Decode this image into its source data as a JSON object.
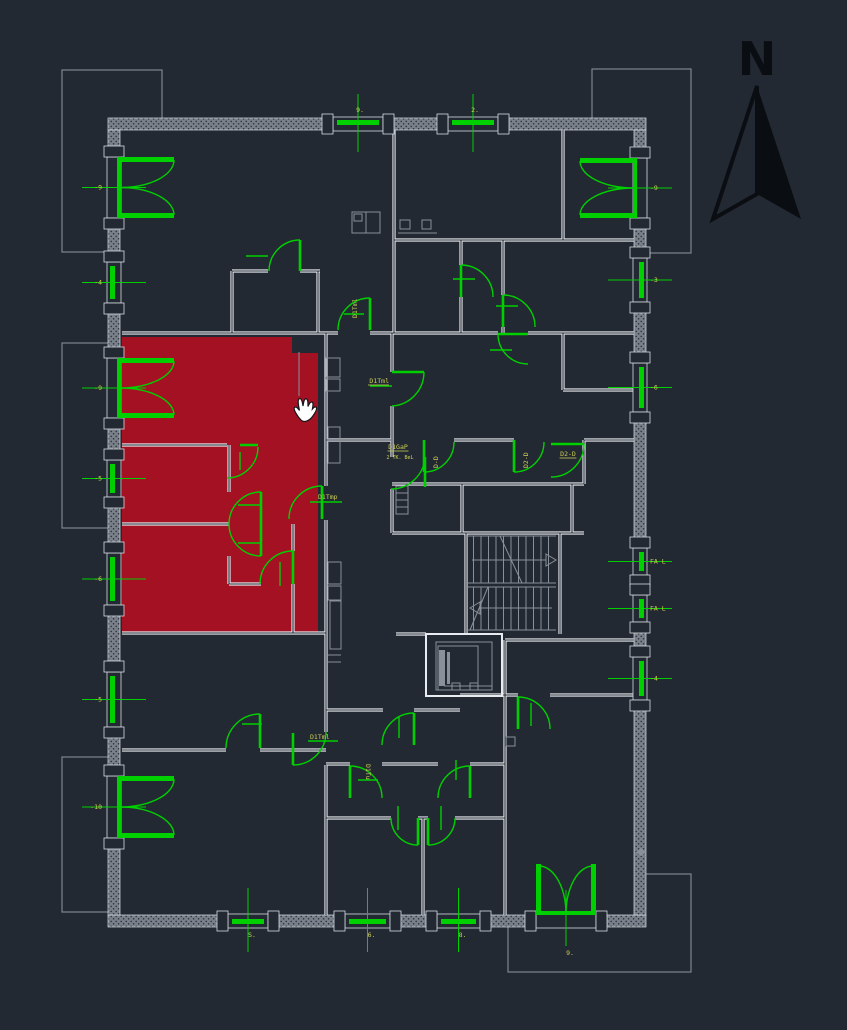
{
  "meta": {
    "width": 847,
    "height": 1030,
    "app": "cad-floorplan-view"
  },
  "colors": {
    "bg": "#232933",
    "wall_base": "#79808a",
    "wall_dot": "#2c323c",
    "wall_edge": "#d6dbe1",
    "interior_wall": "#e8ebef",
    "gray": "#8a9099",
    "green": "#00d000",
    "yellow": "#cdd155",
    "red": "#a31123",
    "black": "#0a0d12",
    "cursor_fill": "#ffffff",
    "cursor_edge": "#14161a"
  },
  "north": {
    "label": "N",
    "solid": "M757,86 L801,219 L757,194 Z",
    "outline": "M757,86 L713,219 L757,194 Z"
  },
  "plan": {
    "building": {
      "x": 108,
      "y": 118,
      "w": 538,
      "h": 809,
      "wall": 12
    },
    "balconies": [
      [
        62,
        70,
        100,
        182
      ],
      [
        62,
        343,
        48,
        185
      ],
      [
        62,
        757,
        48,
        155
      ],
      [
        592,
        69,
        99,
        184
      ],
      [
        508,
        874,
        183,
        98
      ]
    ],
    "wall_segments": [
      [
        108,
        118,
        225,
        12
      ],
      [
        383,
        118,
        65,
        12
      ],
      [
        498,
        118,
        148,
        12
      ],
      [
        108,
        915,
        120,
        12
      ],
      [
        268,
        915,
        77,
        12
      ],
      [
        390,
        915,
        47,
        12
      ],
      [
        480,
        915,
        56,
        12
      ],
      [
        596,
        915,
        50,
        12
      ],
      [
        108,
        130,
        12,
        27
      ],
      [
        108,
        218,
        12,
        44
      ],
      [
        108,
        303,
        12,
        55
      ],
      [
        108,
        418,
        12,
        42
      ],
      [
        108,
        497,
        12,
        56
      ],
      [
        108,
        605,
        12,
        67
      ],
      [
        108,
        727,
        12,
        49
      ],
      [
        108,
        838,
        12,
        77
      ],
      [
        634,
        130,
        12,
        28
      ],
      [
        634,
        218,
        12,
        40
      ],
      [
        634,
        302,
        12,
        61
      ],
      [
        634,
        412,
        12,
        136
      ],
      [
        634,
        575,
        12,
        20
      ],
      [
        634,
        622,
        12,
        35
      ],
      [
        634,
        700,
        12,
        215
      ]
    ],
    "openings": [
      {
        "side": "L",
        "a": 157,
        "b": 218,
        "kind": "dd",
        "label": "-9"
      },
      {
        "side": "L",
        "a": 262,
        "b": 303,
        "kind": "w",
        "label": "-4"
      },
      {
        "side": "L",
        "a": 358,
        "b": 418,
        "kind": "dd",
        "label": "-9"
      },
      {
        "side": "L",
        "a": 460,
        "b": 497,
        "kind": "w",
        "label": "-5"
      },
      {
        "side": "L",
        "a": 553,
        "b": 605,
        "kind": "w",
        "label": "-6"
      },
      {
        "side": "L",
        "a": 672,
        "b": 727,
        "kind": "w",
        "label": "-5"
      },
      {
        "side": "L",
        "a": 776,
        "b": 838,
        "kind": "dd",
        "label": "-10"
      },
      {
        "side": "R",
        "a": 158,
        "b": 218,
        "kind": "dd",
        "label": "-9"
      },
      {
        "side": "R",
        "a": 258,
        "b": 302,
        "kind": "w",
        "label": "-3"
      },
      {
        "side": "R",
        "a": 363,
        "b": 412,
        "kind": "w",
        "label": "-6"
      },
      {
        "side": "R",
        "a": 548,
        "b": 575,
        "kind": "w",
        "label": "FA L"
      },
      {
        "side": "R",
        "a": 595,
        "b": 622,
        "kind": "w",
        "label": "FA L"
      },
      {
        "side": "R",
        "a": 657,
        "b": 700,
        "kind": "w",
        "label": "-4"
      },
      {
        "side": "T",
        "a": 333,
        "b": 383,
        "kind": "w",
        "label": "9."
      },
      {
        "side": "T",
        "a": 448,
        "b": 498,
        "kind": "w",
        "label": "2."
      },
      {
        "side": "B",
        "a": 228,
        "b": 268,
        "kind": "w",
        "label": "S."
      },
      {
        "side": "B",
        "a": 345,
        "b": 390,
        "kind": "w",
        "label": "6."
      },
      {
        "side": "B",
        "a": 437,
        "b": 480,
        "kind": "w",
        "label": "8."
      },
      {
        "side": "B",
        "a": 536,
        "b": 596,
        "kind": "dd",
        "label": "9."
      }
    ],
    "red_unit": {
      "points": "122,337 292,337 292,353 318,353 318,633 122,633"
    },
    "interior_walls": [
      [
        232,
        271,
        268,
        271
      ],
      [
        300,
        271,
        320,
        271
      ],
      [
        122,
        333,
        338,
        333
      ],
      [
        370,
        333,
        498,
        333
      ],
      [
        528,
        333,
        634,
        333
      ],
      [
        394,
        240,
        634,
        240
      ],
      [
        326,
        440,
        391,
        440
      ],
      [
        454,
        440,
        514,
        440
      ],
      [
        584,
        440,
        634,
        440
      ],
      [
        392,
        484,
        584,
        484
      ],
      [
        392,
        533,
        584,
        533
      ],
      [
        122,
        445,
        227,
        445
      ],
      [
        122,
        524,
        229,
        524
      ],
      [
        229,
        584,
        261,
        584
      ],
      [
        122,
        633,
        326,
        633
      ],
      [
        122,
        750,
        226,
        750
      ],
      [
        260,
        750,
        326,
        750
      ],
      [
        326,
        710,
        383,
        710
      ],
      [
        414,
        710,
        460,
        710
      ],
      [
        460,
        695,
        518,
        695
      ],
      [
        550,
        695,
        634,
        695
      ],
      [
        326,
        764,
        350,
        764
      ],
      [
        382,
        764,
        438,
        764
      ],
      [
        470,
        764,
        505,
        764
      ],
      [
        326,
        818,
        391,
        818
      ],
      [
        455,
        818,
        505,
        818
      ],
      [
        418,
        818,
        428,
        818
      ],
      [
        563,
        390,
        634,
        390
      ],
      [
        232,
        271,
        232,
        333
      ],
      [
        318,
        271,
        318,
        333
      ],
      [
        394,
        130,
        394,
        333
      ],
      [
        461,
        240,
        461,
        265
      ],
      [
        461,
        297,
        461,
        333
      ],
      [
        503,
        240,
        503,
        295
      ],
      [
        503,
        327,
        503,
        333
      ],
      [
        563,
        130,
        563,
        240
      ],
      [
        326,
        333,
        326,
        486
      ],
      [
        326,
        520,
        326,
        732
      ],
      [
        326,
        765,
        326,
        915
      ],
      [
        229,
        445,
        229,
        492
      ],
      [
        229,
        556,
        229,
        584
      ],
      [
        293,
        524,
        293,
        551
      ],
      [
        293,
        584,
        293,
        633
      ],
      [
        392,
        333,
        392,
        372
      ],
      [
        392,
        406,
        392,
        457
      ],
      [
        392,
        489,
        392,
        533
      ],
      [
        462,
        484,
        462,
        533
      ],
      [
        572,
        484,
        572,
        533
      ],
      [
        584,
        440,
        584,
        484
      ],
      [
        505,
        640,
        505,
        915
      ],
      [
        505,
        640,
        634,
        640
      ],
      [
        423,
        818,
        423,
        915
      ],
      [
        563,
        333,
        563,
        390
      ],
      [
        466,
        533,
        466,
        634
      ],
      [
        560,
        533,
        560,
        634
      ],
      [
        396,
        634,
        426,
        634
      ]
    ],
    "doors": [
      {
        "leaf": [
          300,
          240,
          300,
          271
        ],
        "arc": "M300,240 A31,31 0 0 0 269,271",
        "tick": [
          246,
          256,
          268,
          256
        ]
      },
      {
        "leaf": [
          370,
          298,
          370,
          330
        ],
        "arc": "M370,298 A32,32 0 0 0 338,330",
        "tick": [
          344,
          314,
          364,
          314
        ],
        "label": {
          "t": "D1Tml",
          "x": 357,
          "y": 318,
          "rot": -90
        }
      },
      {
        "leaf": [
          392,
          372,
          424,
          372
        ],
        "arc": "M424,372 A34,34 0 0 1 392,406",
        "tick": [
          370,
          386,
          392,
          386
        ],
        "label": {
          "t": "D1Tml",
          "x": 389,
          "y": 383,
          "anchor": "end",
          "ul": true
        }
      },
      {
        "leaf": [
          461,
          265,
          461,
          297
        ],
        "arc": "M461,265 A32,32 0 0 1 493,297",
        "tick": [
          453,
          279,
          475,
          279
        ]
      },
      {
        "leaf": [
          503,
          295,
          503,
          327
        ],
        "arc": "M503,295 A32,32 0 0 1 535,327",
        "tick": [
          496,
          306,
          518,
          306
        ]
      },
      {
        "leaf": [
          498,
          334,
          528,
          334
        ],
        "arc": "M498,334 A30,30 0 0 0 528,364",
        "tick": [
          490,
          350,
          512,
          350
        ]
      },
      {
        "leaf": [
          551,
          444,
          584,
          444
        ],
        "arc": "M584,444 A33,33 0 0 1 551,477",
        "label": {
          "t": "D2-D",
          "x": 568,
          "y": 456,
          "anchor": "middle",
          "ul": true
        }
      },
      {
        "leaf": [
          424,
          440,
          424,
          472
        ],
        "arc": "M424,472 A30,30 0 0 0 454,442",
        "label": {
          "t": "D-D",
          "x": 438,
          "y": 468,
          "rot": -90
        }
      },
      {
        "leaf": [
          514,
          440,
          514,
          472
        ],
        "arc": "M514,472 A30,30 0 0 0 544,442",
        "label": {
          "t": "D2-D",
          "x": 528,
          "y": 468,
          "rot": -90
        }
      },
      {
        "leaf": [
          425,
          457,
          425,
          487
        ],
        "arc": "M425,457 A34,34 0 0 1 391,489",
        "label": {
          "t": "D1GaP",
          "x": 398,
          "y": 449,
          "anchor": "middle",
          "ul": true
        },
        "label2": {
          "t": "2 TK. BeL",
          "x": 400,
          "y": 459,
          "anchor": "middle"
        }
      },
      {
        "leaf": [
          322,
          486,
          322,
          519
        ],
        "arc": "M322,486 A33,33 0 0 0 289,519",
        "tick": [
          310,
          502,
          342,
          502
        ],
        "label": {
          "t": "D1Tmp",
          "x": 318,
          "y": 499
        }
      },
      {
        "leaf": [
          261,
          492,
          261,
          524
        ],
        "arc": "M261,492 A32,32 0 0 0 229,524",
        "tick": [
          238,
          505,
          260,
          505
        ]
      },
      {
        "leaf": [
          261,
          556,
          261,
          524
        ],
        "arc": "M261,556 A32,32 0 0 1 229,524",
        "tick": [
          238,
          543,
          260,
          543
        ]
      },
      {
        "leaf": [
          293,
          551,
          293,
          584
        ],
        "arc": "M293,551 A33,33 0 0 0 260,584",
        "tick": [
          280,
          562,
          280,
          586
        ]
      },
      {
        "leaf": [
          240,
          445,
          258,
          445
        ],
        "arc": "M258,447 A31,31 0 0 1 227,478",
        "tick": [
          240,
          452,
          240,
          470
        ]
      },
      {
        "leaf": [
          260,
          714,
          260,
          748
        ],
        "arc": "M260,714 A34,34 0 0 0 226,748",
        "tick": [
          242,
          724,
          262,
          724
        ]
      },
      {
        "leaf": [
          293,
          733,
          293,
          765
        ],
        "arc": "M293,765 A33,33 0 0 0 326,732",
        "tick": [
          308,
          741,
          338,
          741
        ],
        "label": {
          "t": "D1Tml",
          "x": 310,
          "y": 739
        }
      },
      {
        "leaf": [
          350,
          766,
          350,
          798
        ],
        "arc": "M350,766 A32,32 0 0 1 382,798",
        "tick": [
          358,
          780,
          378,
          780
        ],
        "label": {
          "t": "D1Tu",
          "x": 366,
          "y": 764,
          "rot": 90
        }
      },
      {
        "leaf": [
          470,
          766,
          470,
          798
        ],
        "arc": "M470,766 A32,32 0 0 0 438,798",
        "tick": [
          456,
          760,
          456,
          780
        ]
      },
      {
        "leaf": [
          418,
          818,
          418,
          845
        ],
        "arc": "M391,818 A27,27 0 0 0 418,845",
        "tick": [
          398,
          806,
          398,
          830
        ]
      },
      {
        "leaf": [
          428,
          818,
          428,
          845
        ],
        "arc": "M455,818 A27,27 0 0 1 428,845",
        "tick": [
          441,
          806,
          441,
          830
        ]
      },
      {
        "leaf": [
          414,
          713,
          414,
          745
        ],
        "arc": "M414,713 A32,32 0 0 0 382,745",
        "tick": [
          399,
          716,
          399,
          738
        ]
      },
      {
        "leaf": [
          518,
          697,
          518,
          729
        ],
        "arc": "M518,697 A32,32 0 0 1 550,729",
        "tick": [
          531,
          703,
          531,
          726
        ]
      }
    ],
    "stairs": {
      "x": 466,
      "y1": 536,
      "y2": 583,
      "y3": 587,
      "y4": 630,
      "w": 90,
      "treads": 12,
      "up_arrow": [
        472,
        560,
        546,
        560
      ],
      "up_head": "546,554 556,560 546,566",
      "dn_arrow": [
        480,
        608,
        552,
        608
      ],
      "dn_head": "480,602 470,608 480,614",
      "diag1": [
        500,
        536,
        522,
        583
      ],
      "diag2": [
        488,
        587,
        470,
        630
      ]
    },
    "elevator": {
      "outer": [
        426,
        634,
        76,
        62
      ],
      "inner": [
        436,
        642,
        56,
        48
      ],
      "car": [
        438,
        646,
        40,
        44
      ],
      "rails": [
        [
          439,
          650,
          6,
          36
        ],
        [
          447,
          652,
          3,
          32
        ]
      ],
      "lines": [
        [
          444,
          686,
          492,
          686
        ],
        [
          444,
          690,
          492,
          690
        ]
      ],
      "boxes": [
        [
          452,
          683,
          8,
          7
        ],
        [
          470,
          683,
          8,
          7
        ]
      ]
    },
    "fixtures_rects": [
      [
        352,
        212,
        28,
        21
      ],
      [
        354,
        214,
        8,
        7
      ],
      [
        400,
        220,
        10,
        9
      ],
      [
        422,
        220,
        9,
        9
      ],
      [
        326,
        358,
        14,
        19
      ],
      [
        326,
        379,
        14,
        12
      ],
      [
        328,
        427,
        12,
        36
      ],
      [
        328,
        562,
        13,
        22
      ],
      [
        328,
        586,
        13,
        14
      ],
      [
        330,
        601,
        11,
        48
      ],
      [
        396,
        486,
        12,
        28
      ],
      [
        506,
        737,
        9,
        9
      ]
    ],
    "fixtures_lines": [
      [
        366,
        212,
        366,
        233
      ],
      [
        398,
        233,
        437,
        233
      ],
      [
        396,
        493,
        408,
        493
      ],
      [
        396,
        500,
        408,
        500
      ],
      [
        396,
        507,
        408,
        507
      ],
      [
        328,
        655,
        341,
        655
      ],
      [
        328,
        662,
        341,
        662
      ],
      [
        299,
        352,
        299,
        396
      ]
    ],
    "diamond": "636,852 641,848 646,852 641,856",
    "cursor": {
      "x": 291,
      "y": 394,
      "path": "M10,26 C6,22 2,15 3.5,13.5 C5,12.2 7,14 8.5,16.5 C7,10 6.5,5 8.6,4.6 C10.6,4.2 11.4,8 12,12 C12.6,8 13.2,4.5 15.2,4.8 C17.2,5.1 17,9 17,12.5 C18.4,9.5 19.6,7.4 21.2,8.2 C22.8,9 21.8,12.4 21.4,15 C23,13 24.6,12.2 25.4,13.6 C26.4,15.4 24,19 21.6,22.4 C19.2,25.8 13.6,29.6 10,26 Z"
    }
  }
}
